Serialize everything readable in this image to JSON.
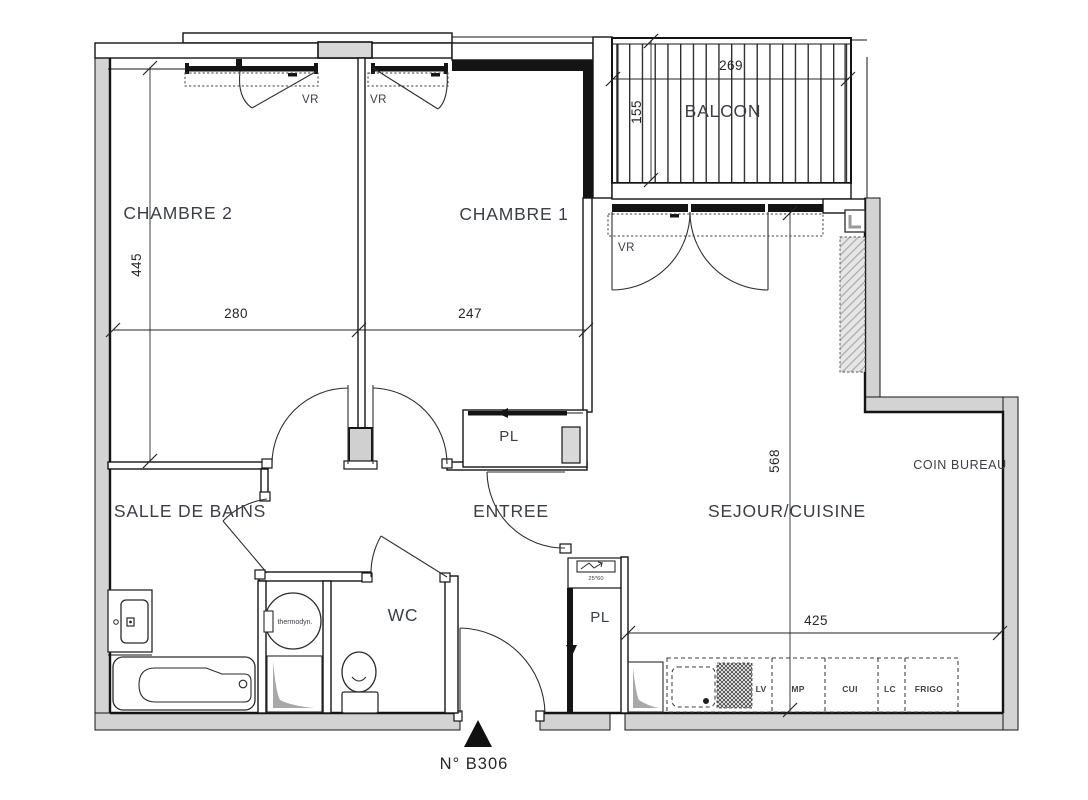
{
  "unit": {
    "number_label": "N° B306"
  },
  "rooms": {
    "chambre2": "CHAMBRE 2",
    "chambre1": "CHAMBRE 1",
    "balcon": "BALCON",
    "salle_de_bains": "SALLE DE BAINS",
    "entree": "ENTREE",
    "wc": "WC",
    "sejour_cuisine": "SEJOUR/CUISINE",
    "coin_bureau": "COIN BUREAU",
    "placard_entree": "PL",
    "placard_cuisine": "PL"
  },
  "dimensions": {
    "chambre2_height": "445",
    "chambre2_width": "280",
    "chambre1_width": "247",
    "balcon_width": "269",
    "balcon_depth": "155",
    "sejour_height": "568",
    "sejour_width": "425"
  },
  "shutter_label": "VR",
  "equipment": {
    "water_heater": "thermodyn.",
    "electric_panel": "25*60",
    "kitchen_units": [
      "LV",
      "MP",
      "CUI",
      "LC",
      "FRIGO"
    ]
  }
}
